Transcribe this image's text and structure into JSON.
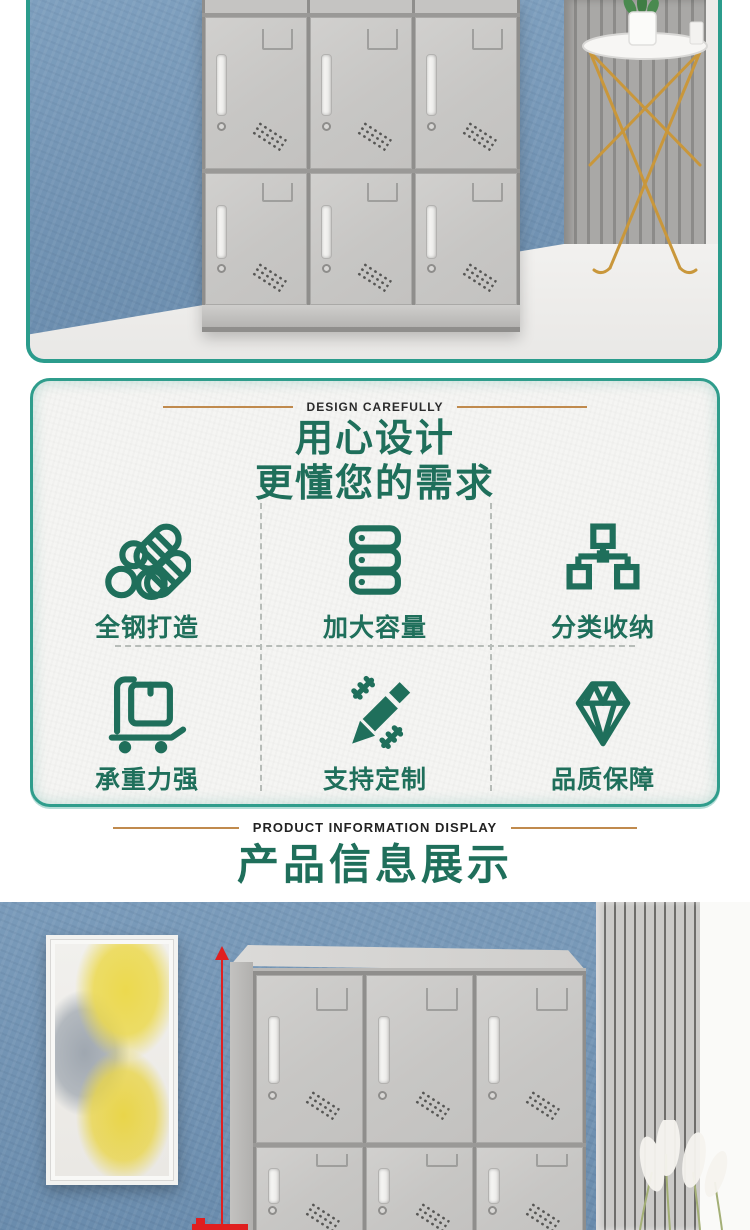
{
  "design_panel": {
    "eyebrow": "DESIGN CAREFULLY",
    "title_line1": "用心设计",
    "title_line2": "更懂您的需求",
    "features": [
      {
        "label": "全钢打造",
        "icon": "steel-pipes-icon"
      },
      {
        "label": "加大容量",
        "icon": "server-stack-icon"
      },
      {
        "label": "分类收纳",
        "icon": "org-chart-icon"
      },
      {
        "label": "承重力强",
        "icon": "hand-truck-icon"
      },
      {
        "label": "支持定制",
        "icon": "pencil-ruler-icon"
      },
      {
        "label": "品质保障",
        "icon": "diamond-icon"
      }
    ]
  },
  "product_info_section": {
    "eyebrow": "PRODUCT INFORMATION DISPLAY",
    "title": "产品信息展示"
  },
  "colors": {
    "accent_teal": "#1f6f5b",
    "frame_teal": "#2b9c8c",
    "gold_line": "#c08a4d",
    "eyebrow_text": "#2b2b2b",
    "wall_blue": "#7394b4",
    "locker_gray": "#c7c6c4",
    "dimension_red": "#e01f1f",
    "painting_yellow": "#ecd94e"
  }
}
